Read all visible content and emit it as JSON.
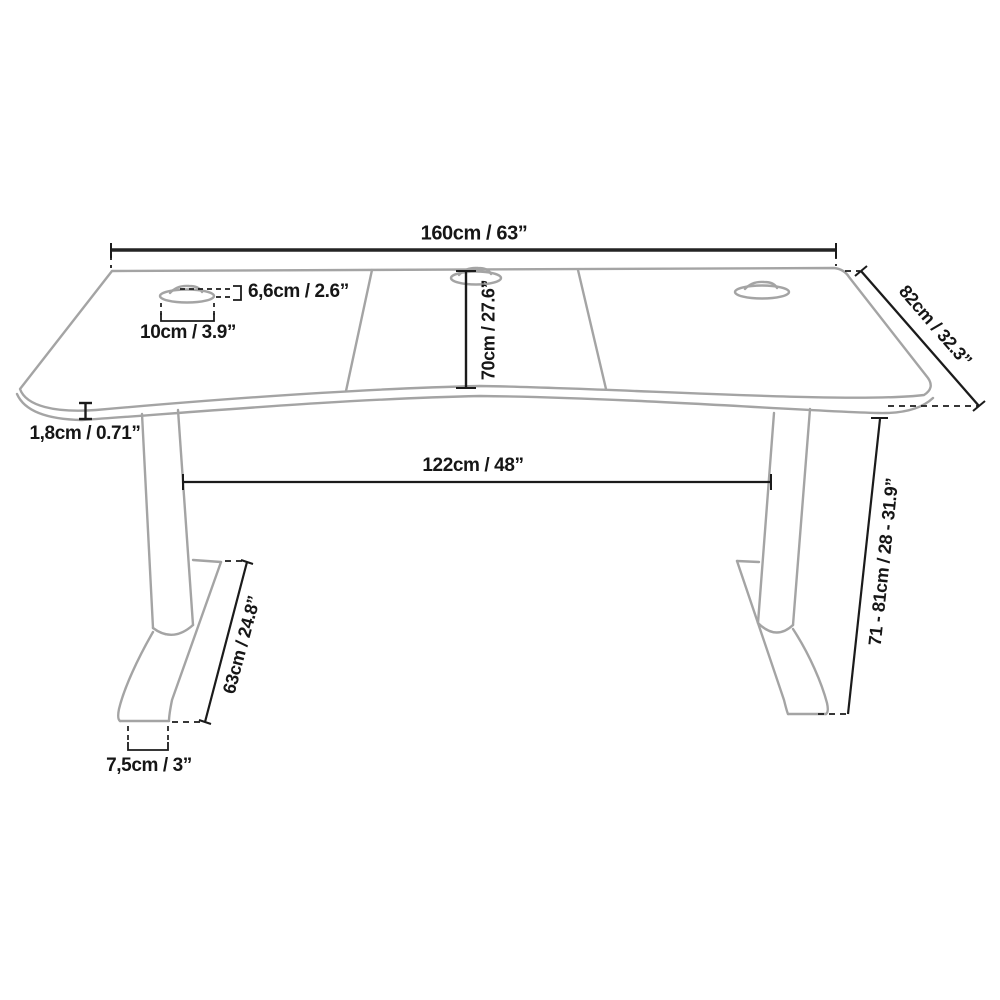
{
  "diagram": {
    "type": "technical-line-drawing",
    "subject": "height-adjustable desk with dimension annotations",
    "units": "cm / inches"
  },
  "labels": {
    "desktop_width": "160cm / 63”",
    "desktop_depth": "82cm / 32.3”",
    "grommet_height": "6,6cm / 2.6”",
    "grommet_width": "10cm / 3.9”",
    "center_depth": "70cm / 27.6”",
    "desktop_thickness": "1,8cm / 0.71”",
    "leg_distance": "122cm / 48”",
    "foot_length": "63cm / 24.8”",
    "foot_width": "7,5cm / 3”",
    "height_range": "71 - 81cm / 28 - 31.9”"
  },
  "colors": {
    "background": "#ffffff",
    "product_outline_grey": "#a4a4a4",
    "dimension_line_black": "#1b1b1b",
    "label_text": "#161616"
  }
}
